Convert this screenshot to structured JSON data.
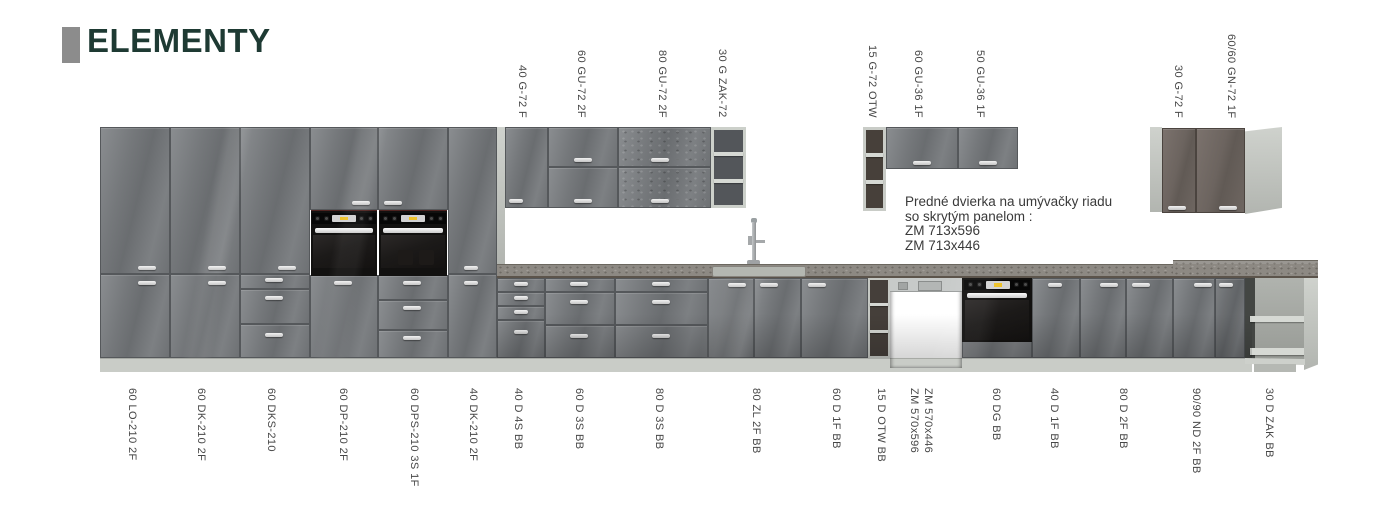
{
  "title": "ELEMENTY",
  "annotation": {
    "lines": [
      "Predné dvierka na umývačky riadu",
      "so skrytým panelom :",
      "ZM 713x596",
      "ZM 713x446"
    ]
  },
  "top_labels": [
    "40 G-72 F",
    "60 GU-72 2F",
    "80 GU-72 2F",
    "30 G ZAK-72",
    "15 G-72 OTW",
    "60 GU-36 1F",
    "50 GU-36 1F",
    "30 G-72 F",
    "60/60 GN-72 1F"
  ],
  "bottom_labels": [
    "60 LO-210 2F",
    "60 DK-210 2F",
    "60 DKS-210",
    "60 DP-210 2F",
    "60 DPS-210 3S 1F",
    "40 DK-210 2F",
    "40 D 4S BB",
    "60 D 3S BB",
    "80 D 3S BB",
    "80 ZL 2F BB",
    "60 D 1F BB",
    "15 D OTW BB",
    "ZM 570x596",
    "ZM 570x446",
    "60 DG BB",
    "40 D 1F BB",
    "80 D 2F BB",
    "90/90 ND 2F BB",
    "30 D ZAK BB"
  ],
  "colors": {
    "title_text": "#1e3a33",
    "title_bar": "#8c8c8c",
    "label_text": "#474747",
    "cabinet_grey": "#75787b",
    "corner_brown": "#6c645f",
    "countertop": "#8d8983",
    "plinth": "#c9ccc7"
  }
}
